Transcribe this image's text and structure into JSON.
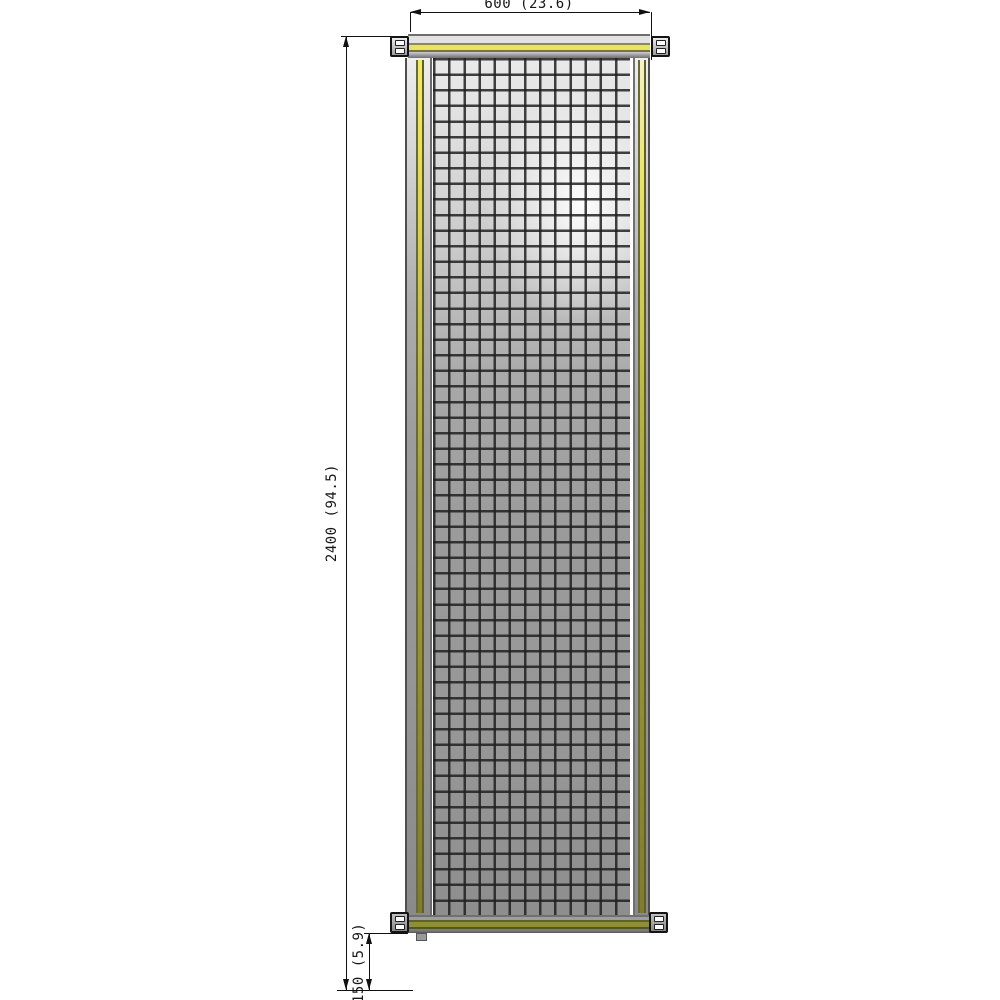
{
  "drawing": {
    "type": "technical elevation drawing of a yellow-framed wire-mesh safety guard panel",
    "dimensions": {
      "width": {
        "label": "600 (23.6)"
      },
      "height": {
        "label": "2400 (94.5)"
      },
      "clearance": {
        "label": "150 (5.9)"
      }
    },
    "colors": {
      "background": "#ffffff",
      "accent_yellow": "#e8e45e",
      "accent_olive": "#8f8e38",
      "frame_gray": "#9a9a9a",
      "mesh_wire": "#2e2e2e",
      "dimension_line": "#111111"
    }
  }
}
